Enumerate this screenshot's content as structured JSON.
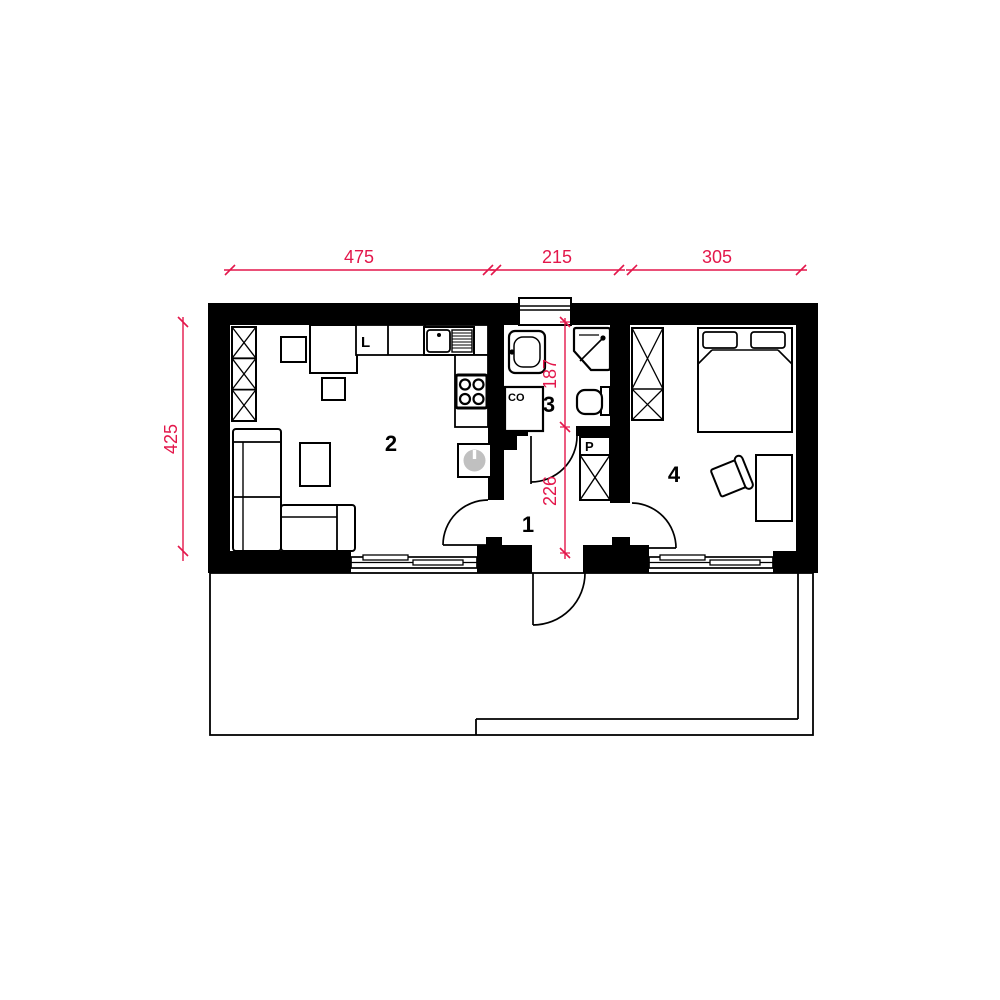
{
  "colors": {
    "dimension_red": "#e3174b",
    "wall_black": "#000000",
    "heater_gray": "#c0c0c0"
  },
  "dimensions": {
    "top": [
      {
        "label": "475"
      },
      {
        "label": "215"
      },
      {
        "label": "305"
      }
    ],
    "left": {
      "label": "425"
    },
    "inner": [
      {
        "label": "187"
      },
      {
        "label": "226"
      }
    ]
  },
  "rooms": [
    {
      "number": "1"
    },
    {
      "number": "2"
    },
    {
      "number": "3"
    },
    {
      "number": "4"
    }
  ],
  "labels": {
    "fridge": "L",
    "heating_unit": "CO",
    "washer": "P"
  }
}
